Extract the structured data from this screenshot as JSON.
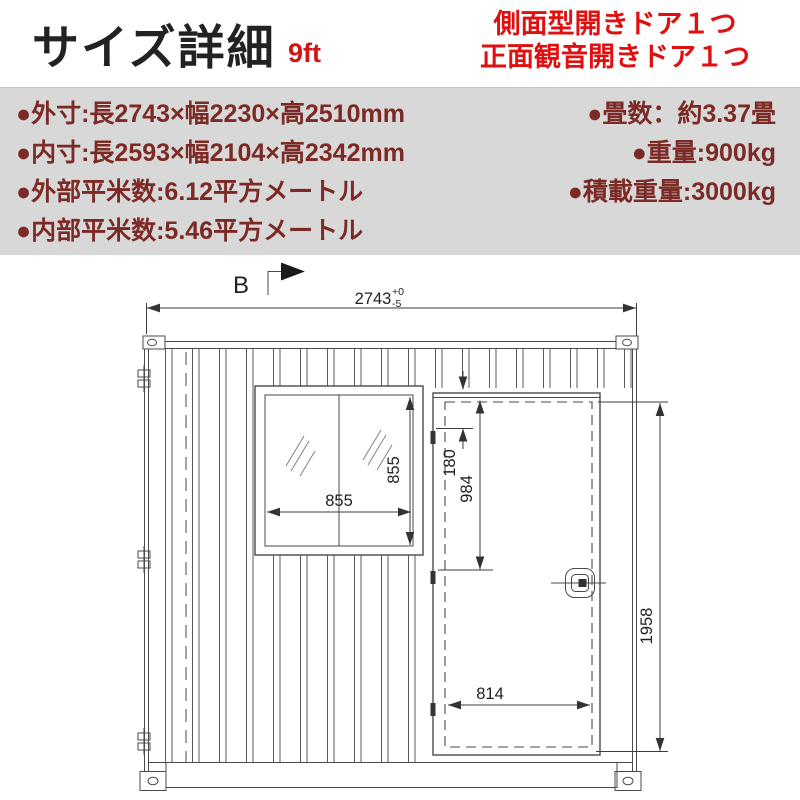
{
  "colors": {
    "accent_orange": "#F2A21B",
    "accent_red": "#E01010",
    "spec_maroon": "#7B2A25",
    "band_gray": "#D8D8D8",
    "drawing_line": "#4A4A4A"
  },
  "header": {
    "title": "サイズ詳細",
    "size_tag": "9ft",
    "door_notes": [
      "側面型開きドア１つ",
      "正面観音開きドア１つ"
    ]
  },
  "specs": {
    "left_rows": [
      "●外寸:長2743×幅2230×高2510mm",
      "●内寸:長2593×幅2104×高2342mm",
      "●外部平米数:6.12平方メートル",
      "●内部平米数:5.46平方メートル"
    ],
    "right_rows": [
      "●畳数：約3.37畳",
      "●重量:900kg",
      "●積載重量:3000kg"
    ]
  },
  "drawing": {
    "view_label": "B",
    "overall_width": "2743",
    "tol_plus": "+0",
    "tol_minus": "-5",
    "window_width": "855",
    "window_height": "855",
    "door_top_offset": "180",
    "door_upper_dim": "984",
    "door_opening_height": "1958",
    "door_opening_width": "814"
  }
}
